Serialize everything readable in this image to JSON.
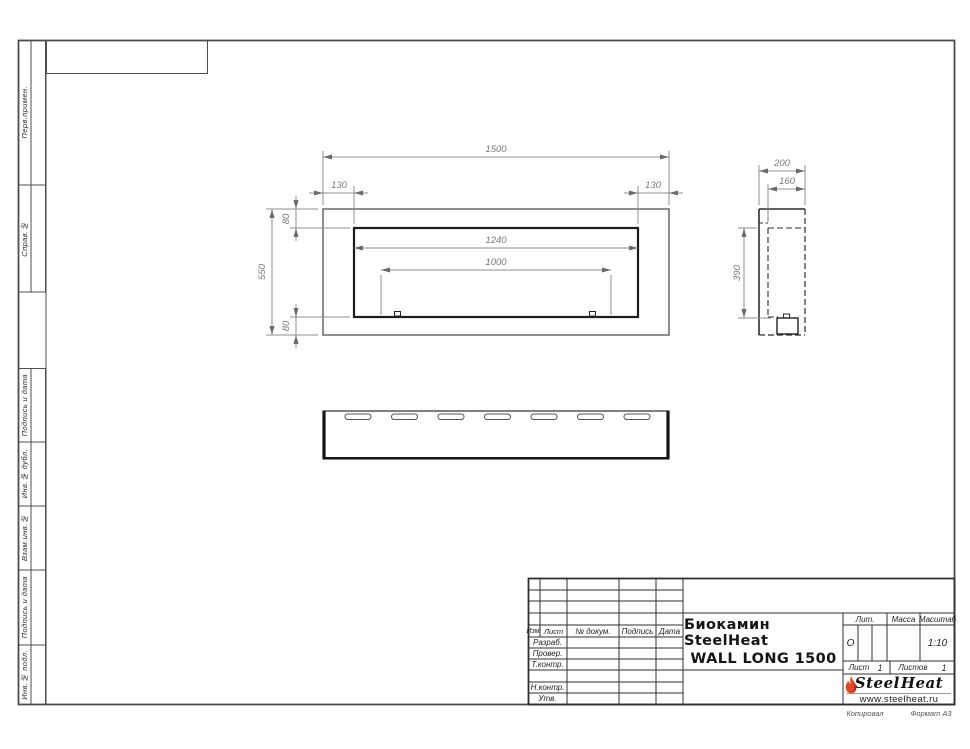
{
  "sidebar": {
    "labels": [
      "Перв.примен.",
      "Справ.№",
      "Подпись и дата",
      "Инв.№ дубл.",
      "Взам.инв.№",
      "Подпись и дата",
      "Инв.№ подл."
    ]
  },
  "dimensions": {
    "front": {
      "overall_width": "1500",
      "side_offset_left": "130",
      "side_offset_right": "130",
      "top_offset": "80",
      "overall_height": "550",
      "bottom_offset": "80",
      "opening_width": "1240",
      "burner_length": "1000"
    },
    "side": {
      "overall_depth": "200",
      "inner_depth": "160",
      "inner_height": "390"
    }
  },
  "title_block": {
    "columns": {
      "izm": "Изм.",
      "sheet": "Лист",
      "doc_no": "№ докум.",
      "signature": "Подпись",
      "date": "Дата"
    },
    "roles": {
      "developed": "Разраб.",
      "checked": "Провер.",
      "tech_control": "Т.контр.",
      "norm_control": "Н.контр.",
      "approved": "Утв."
    },
    "title_line1": "Биокамин SteelHeat",
    "title_line2": "WALL LONG 1500",
    "lit": {
      "label": "Лит.",
      "value": "О"
    },
    "mass": {
      "label": "Масса",
      "value": ""
    },
    "scale": {
      "label": "Масштаб",
      "value": "1:10"
    },
    "sheet_no": {
      "label": "Лист",
      "value": "1"
    },
    "sheets_total": {
      "label": "Листов",
      "value": "1"
    },
    "logo": {
      "word1": "Steel",
      "word2": "Heat",
      "website": "www.steelheat.ru"
    }
  },
  "footer": {
    "copied": "Копировал",
    "format": "Формат А3"
  },
  "colors": {
    "flame_main": "#e04a1e",
    "flame_accent": "#b51f2c",
    "line": "#2f2f2f"
  }
}
